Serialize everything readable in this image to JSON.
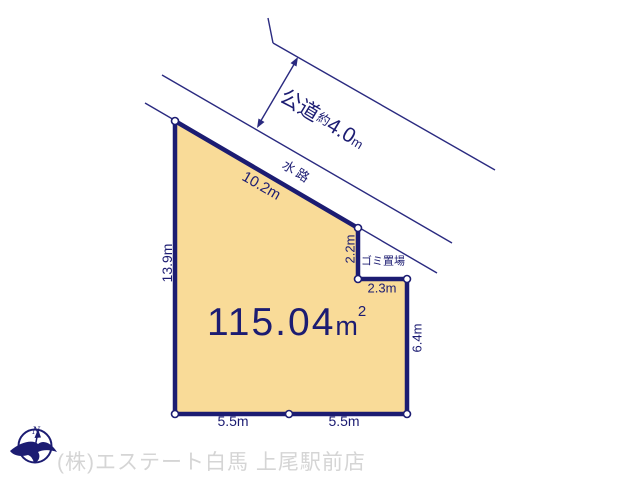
{
  "plot": {
    "area": {
      "value": "115.04",
      "unit": "m",
      "sup": "2"
    },
    "dims": {
      "top": "10.2m",
      "left": "13.9m",
      "notch_vertical": "2.2m",
      "notch_horizontal": "2.3m",
      "right": "6.4m",
      "bottom_left": "5.5m",
      "bottom_right": "5.5m"
    },
    "garbage_area": "ゴミ置場"
  },
  "roads": {
    "public_road": {
      "name": "公道",
      "approx": "約",
      "value": "4.0",
      "unit": "m"
    },
    "waterway": "水路"
  },
  "compass": {
    "north": "N"
  },
  "footer": {
    "company": "(株)エステート白馬 上尾駅前店"
  },
  "colors": {
    "navy": "#1c1c72",
    "plot_fill": "#f9db98",
    "footer_gray": "#d5d5d5",
    "background": "#ffffff"
  }
}
